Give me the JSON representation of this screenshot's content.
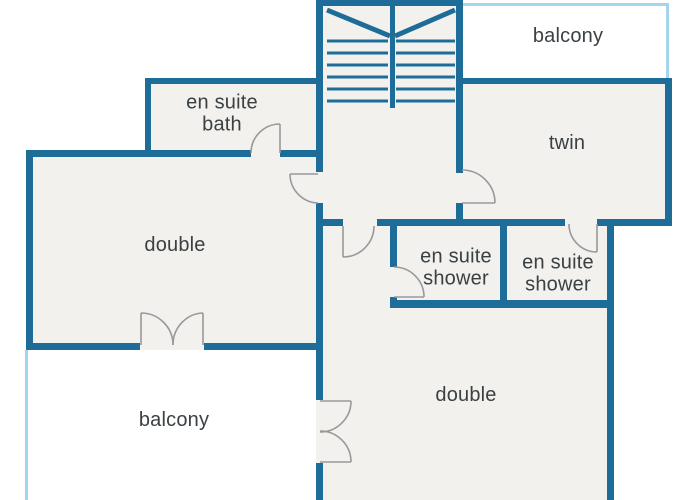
{
  "meta": {
    "type": "floor-plan"
  },
  "colors": {
    "wall": "#1e6d98",
    "balcony_border": "#a3d5ec",
    "room_fill": "#f2f1ee",
    "door": "#98999b",
    "text": "#3b4043",
    "background": "#ffffff"
  },
  "rooms": {
    "balcony_top": {
      "label": "balcony"
    },
    "en_suite_bath": {
      "label": "en suite bath"
    },
    "twin": {
      "label": "twin"
    },
    "double_left": {
      "label": "double"
    },
    "en_suite_shower_left": {
      "label": "en suite shower"
    },
    "en_suite_shower_right": {
      "label": "en suite shower"
    },
    "double_bottom": {
      "label": "double"
    },
    "balcony_bottom": {
      "label": "balcony"
    }
  }
}
